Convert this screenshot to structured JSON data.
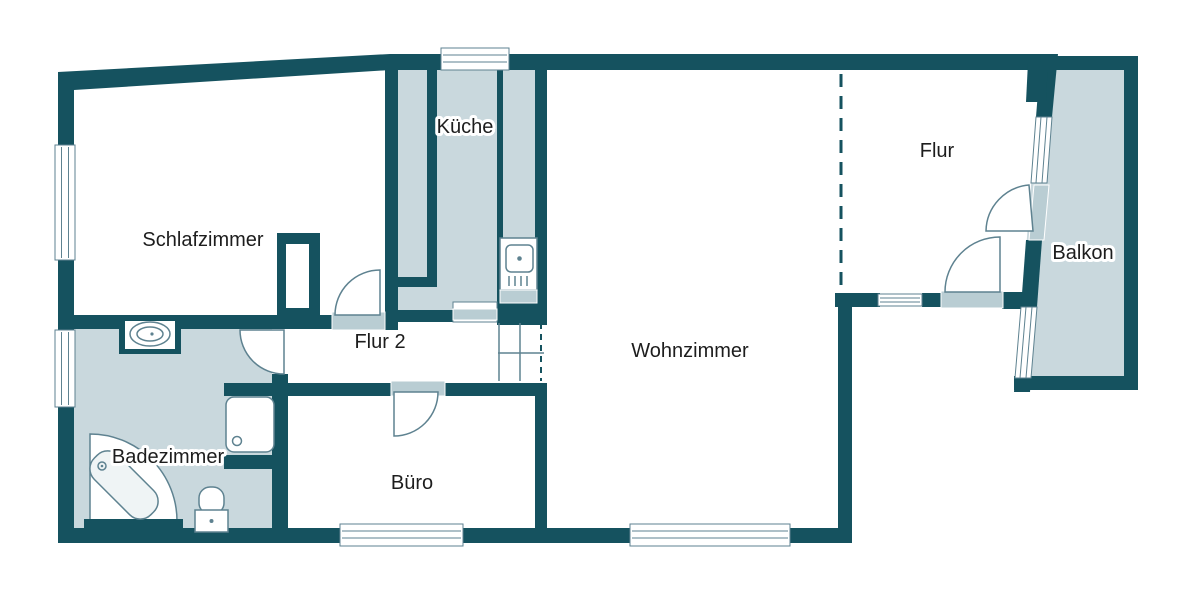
{
  "rooms": {
    "schlafzimmer": {
      "label": "Schlafzimmer"
    },
    "kueche": {
      "label": "Küche"
    },
    "flur2": {
      "label": "Flur 2"
    },
    "wohnzimmer": {
      "label": "Wohnzimmer"
    },
    "flur": {
      "label": "Flur"
    },
    "balkon": {
      "label": "Balkon"
    },
    "badezimmer": {
      "label": "Badezimmer"
    },
    "buero": {
      "label": "Büro"
    }
  },
  "fixtures": [
    "bathtub",
    "shower",
    "toilet",
    "washbasin",
    "stove-sink-unit"
  ],
  "colors": {
    "wall": "#15525f",
    "room_fill": "#c9d8dd",
    "sill": "#b9cdd3",
    "line": "#5e8290",
    "tub_fill": "#eff4f5",
    "label": "#1d1d1d",
    "background": "#ffffff"
  }
}
